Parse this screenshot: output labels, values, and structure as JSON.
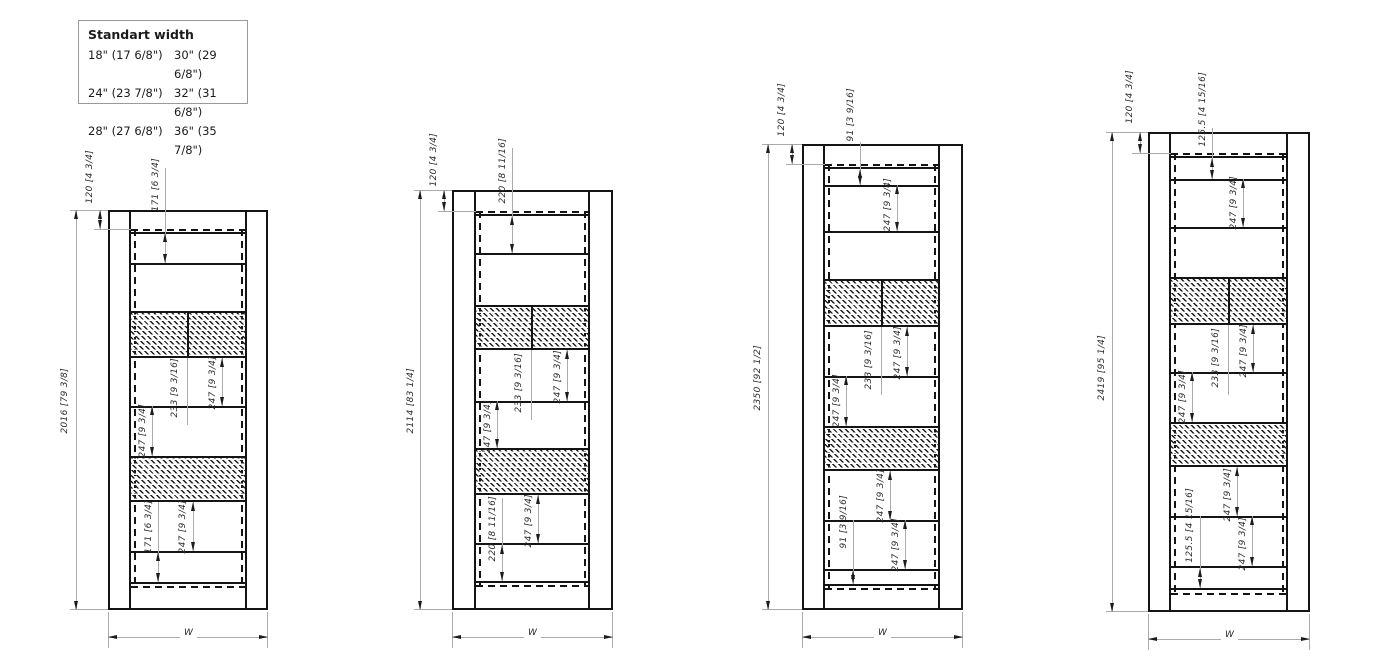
{
  "legend": {
    "title": "Standart width",
    "entries": [
      [
        "18\" (17 6/8\")",
        "30\" (29 6/8\")"
      ],
      [
        "24\" (23 7/8\")",
        "32\" (31 6/8\")"
      ],
      [
        "28\" (27 6/8\")",
        "36\" (35 7/8\")"
      ]
    ]
  },
  "doors": [
    {
      "id": "door-1",
      "height": "2016 [79 3/8]",
      "top_offset": "120 [4 3/4]",
      "width_label": "W",
      "dims": {
        "top": "171 [6 3/4]",
        "mid_right": "247 [9 3/4]",
        "hatch": "233 [9 3/16]",
        "mid_left": "247 [9 3/4]",
        "lower": "247 [9 3/4]",
        "bottom": "171 [6 3/4]"
      }
    },
    {
      "id": "door-2",
      "height": "2114 [83 1/4]",
      "top_offset": "120 [4 3/4]",
      "width_label": "W",
      "dims": {
        "top": "220 [8 11/16]",
        "mid_right": "247 [9 3/4]",
        "hatch": "233 [9 3/16]",
        "mid_left": "247 [9 3/4]",
        "lower": "247 [9 3/4]",
        "bottom": "220 [8 11/16]"
      }
    },
    {
      "id": "door-3",
      "height": "2350 [92 1/2]",
      "top_offset": "120 [4 3/4]",
      "width_label": "W",
      "dims": {
        "top_small": "91 [3 9/16]",
        "top_247": "247 [9 3/4]",
        "mid_right": "247 [9 3/4]",
        "hatch": "233 [9 3/16]",
        "mid_left": "247 [9 3/4]",
        "lower_a": "247 [9 3/4]",
        "lower_b": "247 [9 3/4]",
        "bottom_small": "91 [3 9/16]"
      }
    },
    {
      "id": "door-4",
      "height": "2419 [95 1/4]",
      "top_offset": "120 [4 3/4]",
      "width_label": "W",
      "dims": {
        "top_small": "125.5 [4 15/16]",
        "top_247": "247 [9 3/4]",
        "mid_right": "247 [9 3/4]",
        "hatch": "233 [9 3/16]",
        "mid_left": "247 [9 3/4]",
        "lower_a": "247 [9 3/4]",
        "lower_b": "247 [9 3/4]",
        "bottom_small": "125.5 [4 15/16]"
      }
    }
  ]
}
